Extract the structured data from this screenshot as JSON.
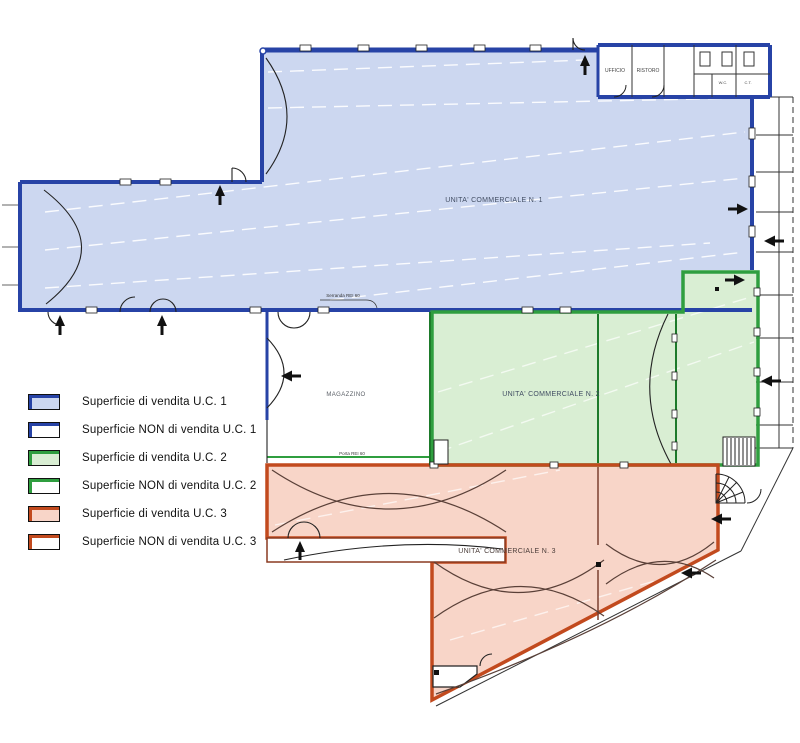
{
  "legend": {
    "items": [
      {
        "label": "Superficie di vendita U.C. 1",
        "unit": "U.C. 1",
        "variant": "vendita",
        "color": "#2743a6",
        "fill": "#ccd7f0"
      },
      {
        "label": "Superficie NON di vendita U.C. 1",
        "unit": "U.C. 1",
        "variant": "non-vendita",
        "color": "#2743a6",
        "fill": "#ffffff"
      },
      {
        "label": "Superficie di vendita U.C. 2",
        "unit": "U.C. 2",
        "variant": "vendita",
        "color": "#2f9e3f",
        "fill": "#d9eed3"
      },
      {
        "label": "Superficie NON di vendita U.C. 2",
        "unit": "U.C. 2",
        "variant": "non-vendita",
        "color": "#2f9e3f",
        "fill": "#ffffff"
      },
      {
        "label": "Superficie di vendita U.C. 3",
        "unit": "U.C. 3",
        "variant": "vendita",
        "color": "#c24a1e",
        "fill": "#f8d5c8"
      },
      {
        "label": "Superficie NON di vendita U.C. 3",
        "unit": "U.C. 3",
        "variant": "non-vendita",
        "color": "#c24a1e",
        "fill": "#ffffff"
      }
    ]
  },
  "plan": {
    "labels": {
      "uc1": "UNITA' COMMERCIALE N. 1",
      "uc2": "UNITA' COMMERCIALE N. 2",
      "uc3": "UNITA' COMMERCIALE N. 3",
      "magazzino": "MAGAZZINO",
      "ufficio": "UFFICIO",
      "ristoro": "RISTORO",
      "wc": "W.C.",
      "ct": "C.T.",
      "annotation_top": "Serranda REI 60",
      "annotation_mid": "Porta REI 60"
    },
    "colors": {
      "uc1_fill": "#ccd7f0",
      "uc1_stroke": "#2743a6",
      "uc2_fill": "#d9eed3",
      "uc2_stroke": "#2f9e3f",
      "uc3_fill": "#f8d5c8",
      "uc3_stroke": "#c24a1e",
      "wall": "#1a1a1a"
    }
  }
}
